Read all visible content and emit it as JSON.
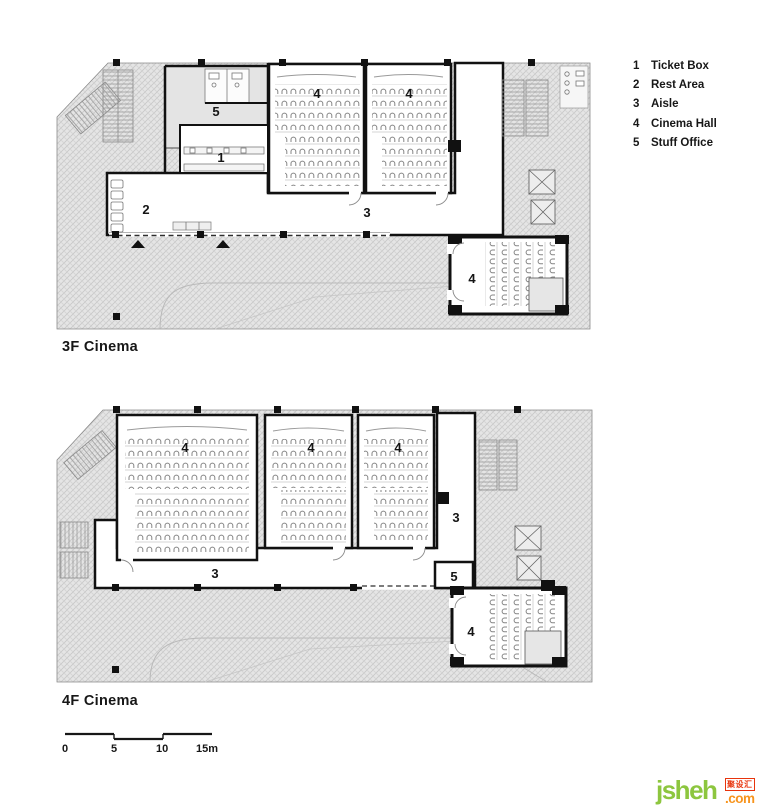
{
  "legend": {
    "items": [
      {
        "num": "1",
        "label": "Ticket Box"
      },
      {
        "num": "2",
        "label": "Rest Area"
      },
      {
        "num": "3",
        "label": "Aisle"
      },
      {
        "num": "4",
        "label": "Cinema Hall"
      },
      {
        "num": "5",
        "label": "Stuff Office"
      }
    ]
  },
  "floors": [
    {
      "title": "3F Cinema",
      "labels": {
        "office": "5",
        "ticket": "1",
        "rest": "2",
        "aisle": "3",
        "hall_a": "4",
        "hall_b": "4",
        "hall_small": "4"
      }
    },
    {
      "title": "4F Cinema",
      "labels": {
        "hall_a": "4",
        "hall_b": "4",
        "hall_c": "4",
        "aisle_v": "3",
        "aisle_h": "3",
        "office": "5",
        "hall_small": "4"
      }
    }
  ],
  "scalebar": {
    "labels": [
      "0",
      "5",
      "10",
      "15m"
    ]
  },
  "watermark": {
    "name": "jsheh",
    "cn": "聚设汇",
    "tld": ".com",
    "colors": {
      "green": "#8dc63f",
      "orange": "#f7941d",
      "red": "#e8340c"
    }
  }
}
